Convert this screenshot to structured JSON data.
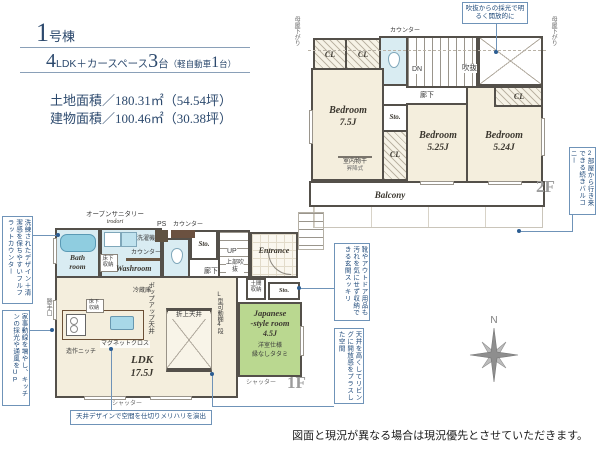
{
  "colors": {
    "accent_blue": "#6f93b8",
    "navy_text": "#2d4a6e",
    "wall": "#54504a",
    "tatami_green": "#bad890",
    "wet_blue": "#d9ecf2",
    "room_beige": "#f4eedd"
  },
  "header": {
    "number": "1",
    "number_suffix": "号棟",
    "ldk_num": "4",
    "ldk_text": "LDK＋カースペース",
    "cars_num": "3",
    "cars_unit": "台",
    "kei_open": "（軽自動車",
    "kei_num": "1",
    "kei_close": "台）",
    "land_area": "土地面積／180.31㎡（54.54坪）",
    "building_area": "建物面積／100.46㎡（30.38坪）"
  },
  "floor2": {
    "floor_label": "2F",
    "cl": "CL",
    "counter": "カウンター",
    "dn": "DN",
    "void": "吹抜",
    "hallway": "廊下",
    "storage": "Sto.",
    "bedroom1": {
      "name": "Bedroom",
      "size": "7.5J"
    },
    "bedroom2": {
      "name": "Bedroom",
      "size": "5.25J"
    },
    "bedroom3": {
      "name": "Bedroom",
      "size": "5.24J"
    },
    "indoor_drying": "室内物干",
    "indoor_drying_type": "昇降式",
    "balcony": "Balcony",
    "moya_sagari": "母屋下がり",
    "callout_void": "吹抜からの採光で明るく開放的に",
    "callout_balcony": "2部屋から行き来できる続きバルコニー"
  },
  "floor1": {
    "floor_label": "1F",
    "bath": "Bath room",
    "washroom": "Washroom",
    "open_sanitary": "オープンサニタリー",
    "open_sanitary_brand": "irodori",
    "washer": "洗濯機",
    "underfloor_storage": "床下収納",
    "counter": "カウンター",
    "ps": "PS",
    "storage": "Sto.",
    "up": "UP",
    "void_above": "上部吹抜",
    "hallway": "廊下",
    "entrance": "Entrance",
    "doma_storage": "土間収納",
    "japanese_name1": "Japanese",
    "japanese_name2": "-style room",
    "japanese_size": "4.5J",
    "japanese_note1": "洋室仕様",
    "japanese_note2": "縁なしタタミ",
    "shelf": "L型可動棚4段",
    "coffered": "折上天井",
    "popup_ceiling": "ポップアップ天井",
    "fridge": "冷蔵庫",
    "magnet": "マグネットクロス",
    "niche": "造作ニッチ",
    "ldk_name": "LDK",
    "ldk_size": "17.5J",
    "kitchen_door": "勝手口",
    "shutter": "シャッター",
    "callout_counter": "洗練されたデザイン＋清潔感を保ちやすいフルフラットカウンター",
    "callout_kitchen": "家事動線を増やし、キッチンの採光や通風をUP",
    "callout_ceiling": "天井デザインで空間を仕切りメリハリを演出",
    "callout_entrance": "靴やアウトドア用品も汚れを気にせず収納できる玄関スッキリ",
    "callout_living": "天井を高くしてリビングに開放感をプラスした空間"
  },
  "compass": "N",
  "disclaimer": "図面と現況が異なる場合は現況優先とさせていただきます。"
}
